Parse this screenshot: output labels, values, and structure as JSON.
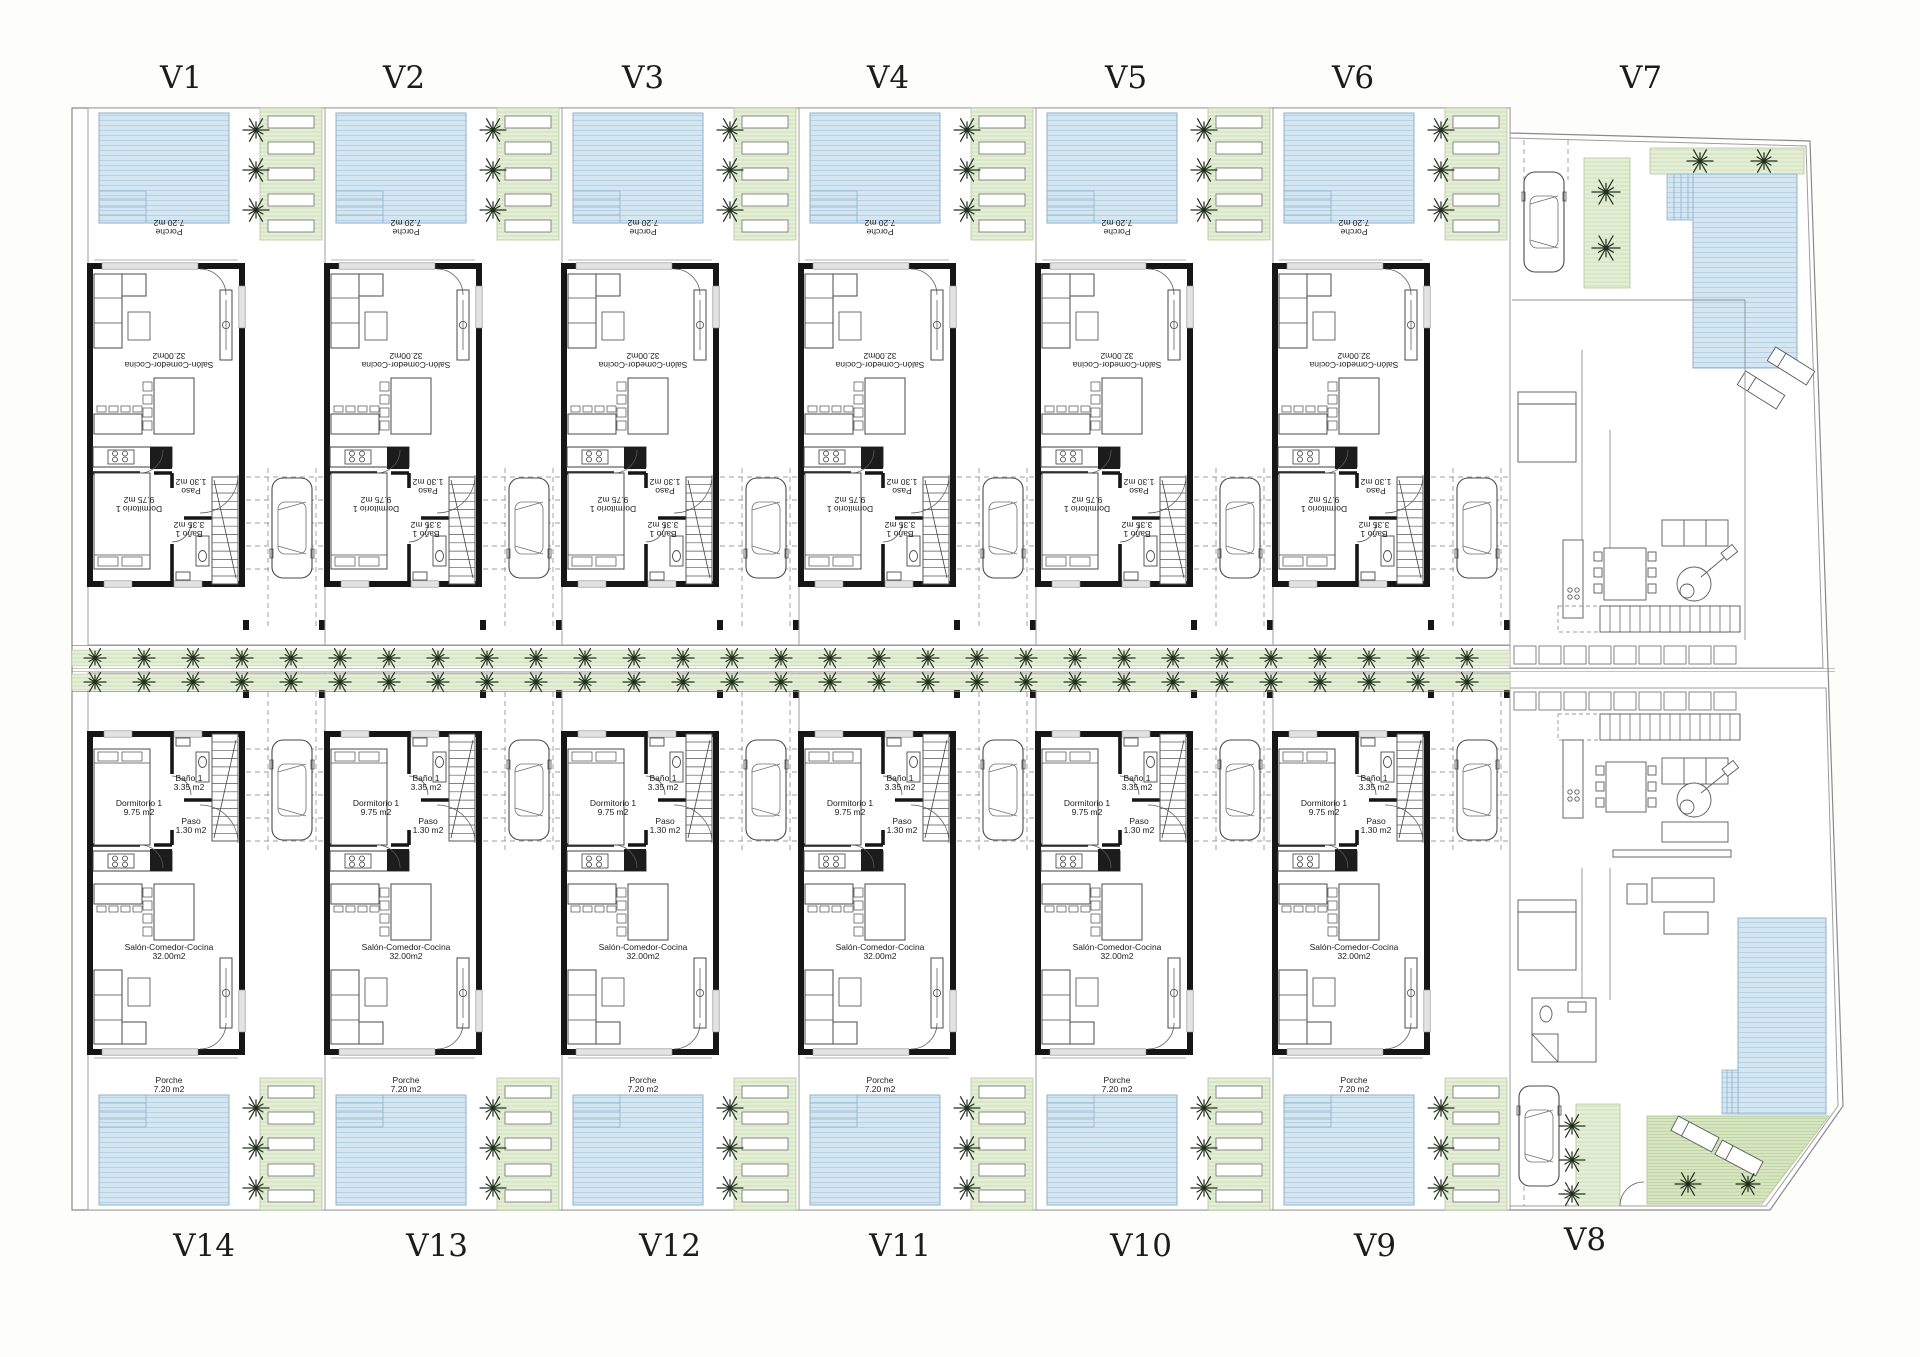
{
  "page": {
    "title": "Site plan - 14 villas",
    "background": "#fdfdfc"
  },
  "villas": {
    "top_row": [
      {
        "id": "V1"
      },
      {
        "id": "V2"
      },
      {
        "id": "V3"
      },
      {
        "id": "V4"
      },
      {
        "id": "V5"
      },
      {
        "id": "V6"
      }
    ],
    "corner_top": {
      "id": "V7"
    },
    "bottom_row": [
      {
        "id": "V14"
      },
      {
        "id": "V13"
      },
      {
        "id": "V12"
      },
      {
        "id": "V11"
      },
      {
        "id": "V10"
      },
      {
        "id": "V9"
      }
    ],
    "corner_bottom": {
      "id": "V8"
    }
  },
  "rooms": {
    "porch_name": "Porche",
    "porch_area": "7.20 m2",
    "salon_name": "Salón-Comedor-Cocina",
    "salon_area": "32.00m2",
    "bedroom_name": "Dormitorio 1",
    "bedroom_area": "9.75 m2",
    "bath_name": "Baño 1",
    "bath_area": "3.35 m2",
    "hall_name": "Paso",
    "hall_area": "1.30 m2"
  },
  "colors": {
    "pool_fill": "#d3e6f2",
    "pool_hatch": "#b2cfe2",
    "pool_edge": "#8fb2c8",
    "garden_fill": "#e5eed7",
    "garden_hatch": "#c8dcb2",
    "garden_edge": "#b4c9a0",
    "garden_dark_fill": "#d9e7c3",
    "garden_dark_hatch": "#b5cd98",
    "wall": "#161616",
    "line_medium": "#4c4c4c",
    "line_thin": "#8f8f8f",
    "plot_edge": "#9d9d9d",
    "palm": "#20301d",
    "text": "#1c1c1c"
  }
}
